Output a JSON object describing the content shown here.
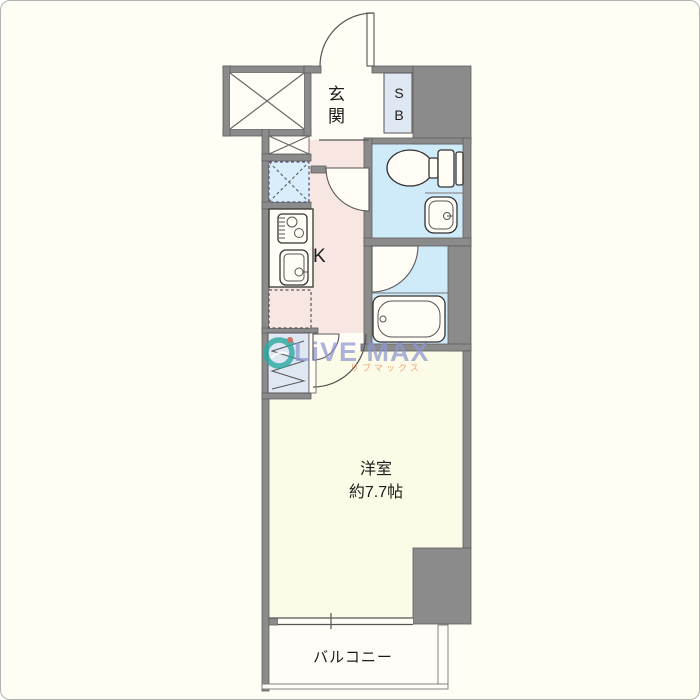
{
  "floorplan": {
    "labels": {
      "entrance": "玄関",
      "shoe_box": "SB",
      "kitchen": "K",
      "western_room": "洋室",
      "western_room_size": "約7.7帖",
      "balcony": "バルコニー"
    },
    "watermark": {
      "brand": "LiVE MAX",
      "brand_kana": "リブマックス"
    },
    "colors": {
      "wall": "#8b8b8b",
      "kitchen_floor": "#f8e6e2",
      "wet_floor": "#cfeaf8",
      "room_floor": "#fbfbe7",
      "hall_floor": "#fffdf6",
      "balcony_floor": "#fffdf8",
      "cabinet_fill": "#dfe7f2",
      "laundry_fill": "#d9eefa",
      "background": "#fffef4",
      "watermark_blue": "#8d97cf",
      "watermark_orange": "#f0a070",
      "logo_teal": "#2ba9a2"
    }
  }
}
